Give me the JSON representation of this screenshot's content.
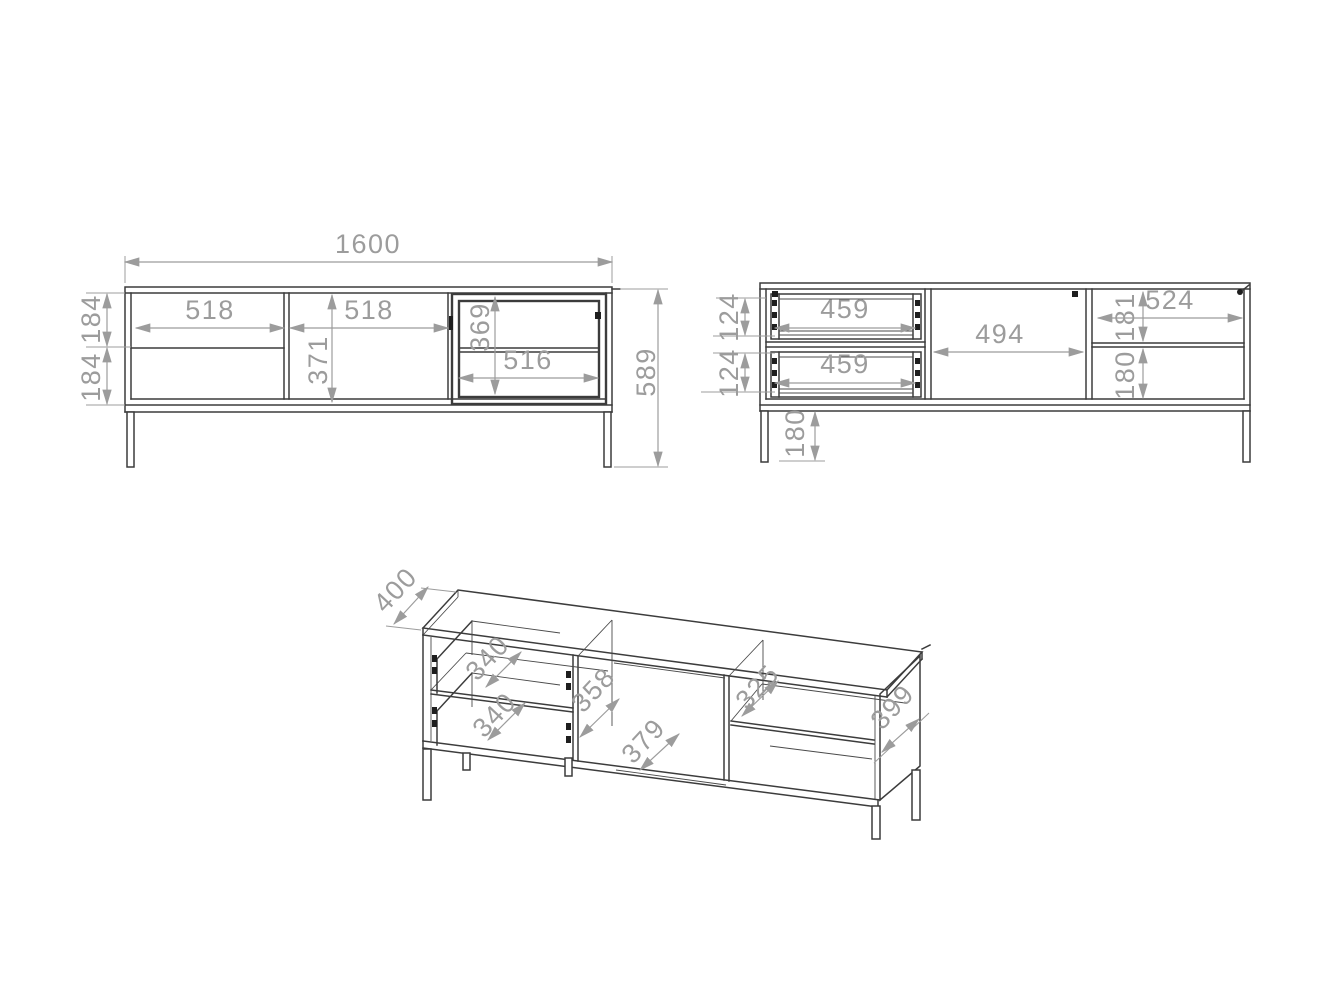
{
  "drawing": {
    "front_view": {
      "total_width": "1600",
      "left_section_width": "518",
      "middle_door_width": "518",
      "middle_door_height": "371",
      "glass_door_height": "369",
      "glass_door_width": "516",
      "upper_drawer_front_height": "184",
      "lower_drawer_front_height": "184",
      "total_height": "589"
    },
    "back_view": {
      "upper_drawer_width": "459",
      "lower_drawer_width": "459",
      "upper_drawer_height": "124",
      "lower_drawer_height": "124",
      "middle_opening_width": "494",
      "right_opening_width": "524",
      "right_upper_height": "181",
      "right_lower_height": "180",
      "leg_height": "180"
    },
    "iso_view": {
      "total_depth": "400",
      "upper_drawer_depth": "340",
      "lower_drawer_depth": "340",
      "middle_compartment_depth": "358",
      "bottom_panel_depth": "379",
      "shelf_depth": "325",
      "side_panel_depth": "399"
    },
    "colors": {
      "edge": "#3c3c3c",
      "dimension": "#9c9c9c",
      "background": "#ffffff"
    }
  }
}
